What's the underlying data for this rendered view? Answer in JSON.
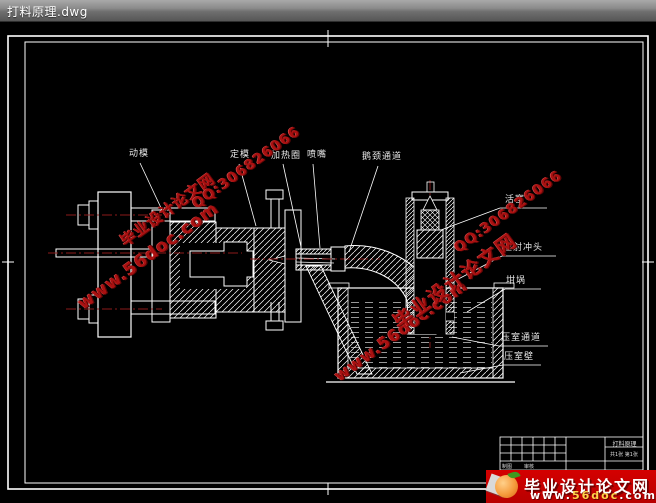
{
  "window": {
    "title": "打料原理.dwg"
  },
  "drawing": {
    "labels": {
      "moving_die": "动模",
      "fixed_die": "定模",
      "heating_ring": "加热圈",
      "nozzle": "喷嘴",
      "gooseneck_channel": "鹅颈通道",
      "piston": "活塞",
      "injection_plunger": "压射冲头",
      "crucible": "坩埚",
      "chamber_channel": "压室通道",
      "chamber_wall": "压室壁"
    },
    "colors": {
      "background": "#000000",
      "lines": "#ffffff",
      "centerline": "#8b1a1a"
    }
  },
  "watermark": {
    "site_name": "毕业设计论文网",
    "url": "www.56doc.com",
    "qq": "QQ:306826066",
    "color": "#aa1111"
  },
  "banner": {
    "site_name": "毕业设计论文网",
    "url_prefix": "www.",
    "url_domain": "56doc",
    "url_suffix": ".com",
    "background": "#c80000"
  },
  "title_block": {
    "drawing_name": "打料原理",
    "sheet_info": "共1张 第1张",
    "cells": [
      "制图",
      "审核"
    ]
  }
}
